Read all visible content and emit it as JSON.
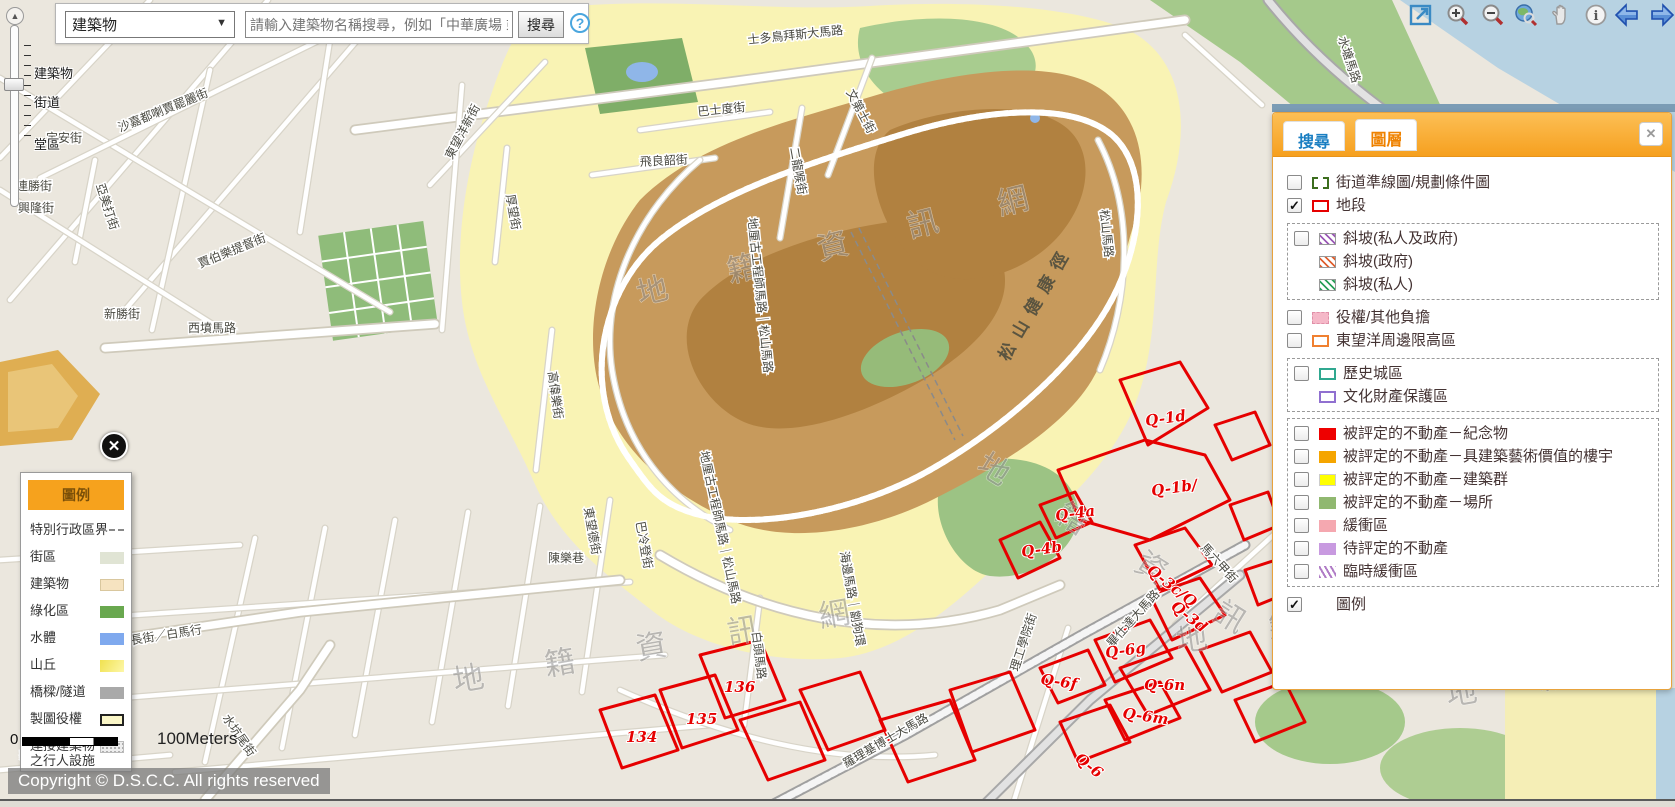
{
  "search_bar": {
    "category_value": "建築物",
    "dropdown_arrow": "▼",
    "placeholder": "請輸入建築物名稱搜尋，例如「中華廣場 或 中",
    "search_button": "搜尋",
    "help_icon": "?"
  },
  "zoom_slider": {
    "top_cap": "▲",
    "labels": [
      {
        "text": "建築物",
        "y": 63
      },
      {
        "text": "街道",
        "y": 92
      },
      {
        "text": "堂區",
        "y": 134
      }
    ]
  },
  "toolbar": {
    "icons": [
      "full-screen",
      "zoom-in",
      "zoom-out",
      "full-extent",
      "pan",
      "info",
      "previous-extent",
      "next-extent"
    ]
  },
  "layers_panel": {
    "tabs": [
      {
        "label": "搜尋",
        "active": false
      },
      {
        "label": "圖層",
        "active": true
      }
    ],
    "close_label": "✕",
    "sections": [
      {
        "boxed": false,
        "rows": [
          {
            "label": "街道準線圖/規劃條件圖",
            "checked": false,
            "swatch": "plan"
          },
          {
            "label": "地段",
            "checked": true,
            "swatch": "lot"
          }
        ]
      },
      {
        "boxed": true,
        "rows": [
          {
            "label": "斜坡(私人及政府)",
            "checked": false,
            "swatch": "slope-both"
          },
          {
            "label": "斜坡(政府)",
            "sub": true,
            "swatch": "slope-gov"
          },
          {
            "label": "斜坡(私人)",
            "sub": true,
            "swatch": "slope-priv"
          }
        ]
      },
      {
        "boxed": false,
        "rows": [
          {
            "label": "役權/其他負擔",
            "checked": false,
            "swatch": "easement"
          },
          {
            "label": "東望洋周邊限高區",
            "checked": false,
            "swatch": "height-limit"
          }
        ]
      },
      {
        "boxed": true,
        "rows": [
          {
            "label": "歷史城區",
            "checked": false,
            "swatch": "historic"
          },
          {
            "label": "文化財產保護區",
            "sub": true,
            "swatch": "heritage"
          }
        ]
      },
      {
        "boxed": true,
        "rows": [
          {
            "label": "被評定的不動產－紀念物",
            "checked": false,
            "swatch": "monument"
          },
          {
            "label": "被評定的不動產－具建築藝術價值的樓宇",
            "checked": false,
            "swatch": "artistic"
          },
          {
            "label": "被評定的不動產－建築群",
            "checked": false,
            "swatch": "complex"
          },
          {
            "label": "被評定的不動產－場所",
            "checked": false,
            "swatch": "site"
          },
          {
            "label": "緩衝區",
            "checked": false,
            "swatch": "buffer"
          },
          {
            "label": "待評定的不動產",
            "checked": false,
            "swatch": "pending"
          },
          {
            "label": "臨時緩衝區",
            "checked": false,
            "swatch": "temp-buffer"
          }
        ]
      },
      {
        "boxed": false,
        "rows": [
          {
            "label": "圖例",
            "checked": true,
            "swatch": "none"
          }
        ]
      }
    ]
  },
  "legend_panel": {
    "title": "圖例",
    "close_label": "✕",
    "items": [
      {
        "label": "特別行政區界",
        "symbol": "admin-boundary"
      },
      {
        "label": "街區",
        "symbol": "block"
      },
      {
        "label": "建築物",
        "symbol": "building"
      },
      {
        "label": "綠化區",
        "symbol": "green"
      },
      {
        "label": "水體",
        "symbol": "water"
      },
      {
        "label": "山丘",
        "symbol": "hill"
      },
      {
        "label": "橋樑/隧道",
        "symbol": "bridge"
      },
      {
        "label": "製圖役權",
        "symbol": "map-easement"
      },
      {
        "label": "連接建築物之行人設施",
        "symbol": "pedestrian",
        "tall": true
      }
    ]
  },
  "scale_bar": {
    "zero": "0",
    "label": "100Meters"
  },
  "copyright": "Copyright © D.S.C.C. All rights reserved",
  "map": {
    "watermark_text": "地 籍 資 訊 網",
    "watermarks": [
      {
        "x": 640,
        "y": 305,
        "r": -14
      },
      {
        "x": 975,
        "y": 470,
        "r": 32
      },
      {
        "x": 455,
        "y": 692,
        "r": -10
      },
      {
        "x": 1178,
        "y": 652,
        "r": -8
      },
      {
        "x": 1448,
        "y": 706,
        "r": -10
      }
    ],
    "street_labels": [
      {
        "text": "水塘馬路",
        "x": 1338,
        "y": 38,
        "r": 72
      },
      {
        "text": "士多鳥拜斯大馬路",
        "x": 748,
        "y": 44,
        "r": -6,
        "size": 13
      },
      {
        "text": "文第士街",
        "x": 846,
        "y": 92,
        "r": 62
      },
      {
        "text": "巴士度街",
        "x": 698,
        "y": 116,
        "r": -6
      },
      {
        "text": "飛良韶街",
        "x": 640,
        "y": 166,
        "r": -3
      },
      {
        "text": "二龍喉街",
        "x": 790,
        "y": 148,
        "r": 80
      },
      {
        "text": "沙嘉都喇賈罷麗街",
        "x": 120,
        "y": 132,
        "r": -22
      },
      {
        "text": "連勝街",
        "x": 16,
        "y": 190
      },
      {
        "text": "興隆街",
        "x": 18,
        "y": 212
      },
      {
        "text": "定安街",
        "x": 46,
        "y": 142
      },
      {
        "text": "亞美打街",
        "x": 96,
        "y": 185,
        "r": 72
      },
      {
        "text": "賈伯樂提督街",
        "x": 200,
        "y": 268,
        "r": -22
      },
      {
        "text": "東望洋新街",
        "x": 452,
        "y": 160,
        "r": -62
      },
      {
        "text": "西墳馬路",
        "x": 188,
        "y": 332
      },
      {
        "text": "新勝街",
        "x": 104,
        "y": 318
      },
      {
        "text": "高偉樂街",
        "x": 548,
        "y": 372,
        "r": 82
      },
      {
        "text": "厚望街",
        "x": 506,
        "y": 195,
        "r": 80
      },
      {
        "text": "醫院後街",
        "x": 28,
        "y": 553
      },
      {
        "text": "陳樂巷",
        "x": 548,
        "y": 562
      },
      {
        "text": "巴冷登街",
        "x": 636,
        "y": 522,
        "r": 80
      },
      {
        "text": "東望德街",
        "x": 584,
        "y": 508,
        "r": 80
      },
      {
        "text": "伯多祿局長街／白馬行",
        "x": 84,
        "y": 652,
        "r": -9
      },
      {
        "text": "水坑尾街",
        "x": 222,
        "y": 718,
        "r": 55
      },
      {
        "text": "家辣堂街",
        "x": 20,
        "y": 760,
        "r": -6
      },
      {
        "text": "白頭馬路",
        "x": 752,
        "y": 632,
        "r": 83
      },
      {
        "text": "地厘古工程師馬路｜松山馬路",
        "x": 748,
        "y": 218,
        "r": 84
      },
      {
        "text": "地厘古工程師馬路｜松山馬路",
        "x": 700,
        "y": 452,
        "r": 78
      },
      {
        "text": "松山馬路",
        "x": 1100,
        "y": 210,
        "r": 84
      },
      {
        "text": "海邊馬路｜劏狗環",
        "x": 840,
        "y": 552,
        "r": 80
      },
      {
        "text": "畢仕達大馬路",
        "x": 1112,
        "y": 648,
        "r": -48,
        "size": 13
      },
      {
        "text": "羅理基博士大馬路",
        "x": 846,
        "y": 768,
        "r": -30,
        "size": 13
      },
      {
        "text": "理工學院街",
        "x": 1018,
        "y": 672,
        "r": -72
      },
      {
        "text": "馬六甲街",
        "x": 1200,
        "y": 548,
        "r": 48
      },
      {
        "text": "松山健康徑",
        "x": 1008,
        "y": 362,
        "r": -60,
        "cls": "path-label"
      }
    ],
    "parcel_labels": [
      {
        "text": "Q-1d",
        "x": 1146,
        "y": 426,
        "r": -8
      },
      {
        "text": "Q-1b/",
        "x": 1152,
        "y": 496,
        "r": -8
      },
      {
        "text": "Q-4a",
        "x": 1056,
        "y": 521,
        "r": -8
      },
      {
        "text": "Q-4b",
        "x": 1022,
        "y": 557,
        "r": -8
      },
      {
        "text": "Q-3c/Q",
        "x": 1146,
        "y": 572,
        "r": 38
      },
      {
        "text": "Q-3d",
        "x": 1170,
        "y": 608,
        "r": 38
      },
      {
        "text": "Q-6g",
        "x": 1106,
        "y": 658,
        "r": -8
      },
      {
        "text": "Q-6f",
        "x": 1040,
        "y": 684,
        "r": 8
      },
      {
        "text": "Q-6n",
        "x": 1144,
        "y": 690
      },
      {
        "text": "Q-6m",
        "x": 1122,
        "y": 718,
        "r": 8
      },
      {
        "text": "Q-6",
        "x": 1074,
        "y": 760,
        "r": 38
      },
      {
        "text": "136",
        "x": 724,
        "y": 692
      },
      {
        "text": "135",
        "x": 686,
        "y": 724
      },
      {
        "text": "134",
        "x": 626,
        "y": 742
      }
    ]
  }
}
